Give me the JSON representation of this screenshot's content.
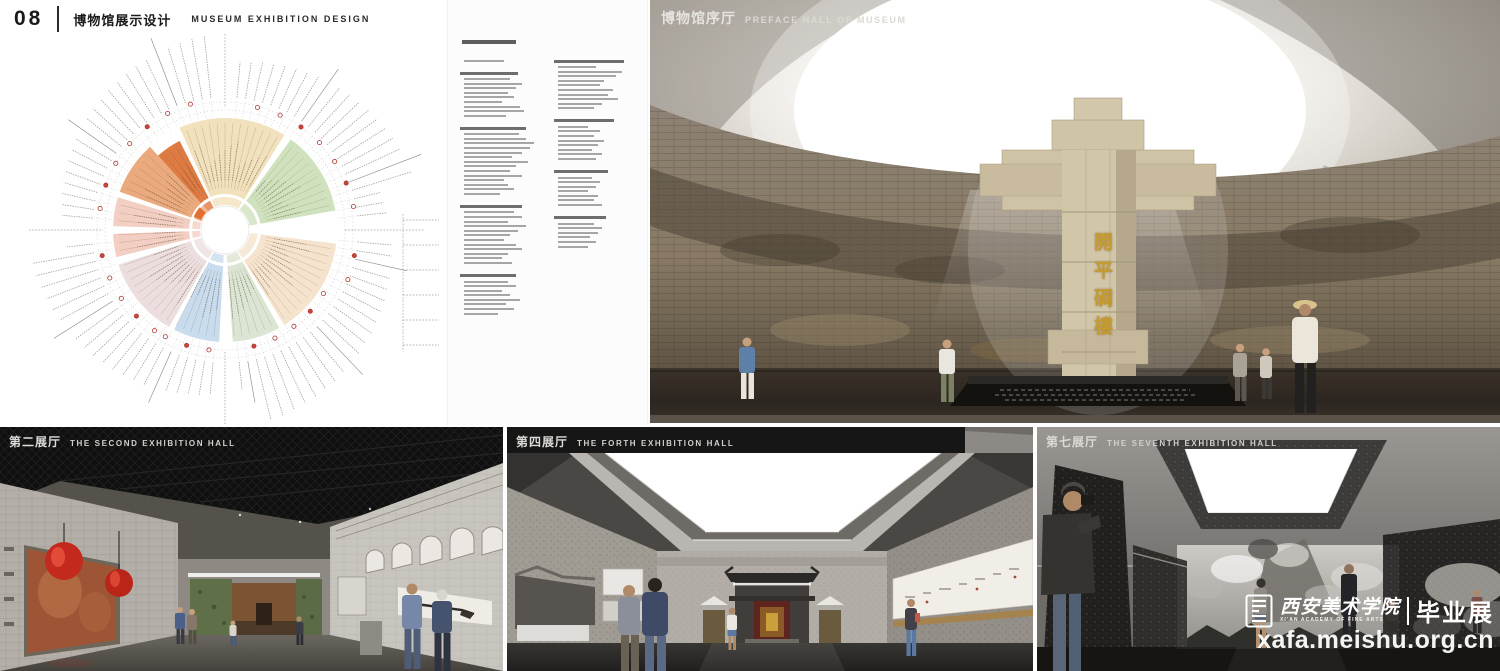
{
  "header": {
    "number": "08",
    "title_zh": "博物馆展示设计",
    "title_en": "MUSEUM EXHIBITION DESIGN"
  },
  "renders": {
    "preface": {
      "label_zh": "博物馆序厅",
      "label_en": "PREFACE HALL OF MUSEUM",
      "monument_text": "開平碉樓",
      "monument_color": "#cfc3a6",
      "gold_color": "#c59b2f"
    },
    "hall2": {
      "label_zh": "第二展厅",
      "label_en": "THE SECOND EXHIBITION HALL",
      "lantern_color": "#c32a1d"
    },
    "hall4": {
      "label_zh": "第四展厅",
      "label_en": "THE FORTH EXHIBITION HALL"
    },
    "hall7": {
      "label_zh": "第七展厅",
      "label_en": "THE SEVENTH EXHIBITION HALL"
    }
  },
  "watermark": {
    "academy_zh": "西安美术学院",
    "academy_en": "XI'AN ACADEMY OF FINE ARTS",
    "exhibition": "毕业展",
    "url": "xafa.meishu.org.cn"
  },
  "diagram": {
    "hole_radius": 18,
    "red_marker_color": "#b23a33",
    "sectors": [
      {
        "start": 336,
        "end": 392,
        "color": "#f2e1bd"
      },
      {
        "start": 36,
        "end": 80,
        "color": "#cfe2bd"
      },
      {
        "start": 97,
        "end": 148,
        "color": "#f5e3cd"
      },
      {
        "start": 151,
        "end": 176,
        "color": "#dce5d3"
      },
      {
        "start": 183,
        "end": 207,
        "color": "#c9dcee"
      },
      {
        "start": 210,
        "end": 252,
        "color": "#ecdede"
      },
      {
        "start": 256,
        "end": 268,
        "color": "#f2cfc2"
      },
      {
        "start": 272,
        "end": 287,
        "color": "#f2cfc2"
      },
      {
        "start": 290,
        "end": 318,
        "color": "#eba97e"
      },
      {
        "start": 318,
        "end": 333,
        "color": "#dd7b43",
        "r2": 100
      }
    ],
    "accent_arc": {
      "start": 293,
      "end": 312,
      "color": "#e06a2a"
    }
  },
  "outline": {
    "columns": [
      [
        {
          "h": 0,
          "lines": [
            40
          ]
        },
        {
          "h": 58,
          "lines": [
            46,
            58,
            52,
            44,
            50,
            38,
            56,
            60,
            42
          ]
        },
        {
          "h": 66,
          "lines": [
            55,
            62,
            70,
            66,
            58,
            48,
            64,
            52,
            46,
            58,
            40,
            44,
            50,
            36
          ]
        },
        {
          "h": 62,
          "lines": [
            50,
            58,
            44,
            62,
            54,
            46,
            40,
            52,
            58,
            44,
            38,
            48
          ]
        },
        {
          "h": 56,
          "lines": [
            44,
            52,
            38,
            46,
            56,
            42,
            50,
            34
          ]
        }
      ],
      [
        {
          "h": 70,
          "lines": [
            38,
            64,
            58,
            46,
            42,
            55,
            50,
            60,
            44,
            36
          ]
        },
        {
          "h": 60,
          "lines": [
            30,
            42,
            36,
            46,
            40,
            34,
            44,
            38
          ]
        },
        {
          "h": 54,
          "lines": [
            34,
            42,
            38,
            30,
            40,
            36,
            44
          ]
        },
        {
          "h": 52,
          "lines": [
            36,
            44,
            40,
            32,
            38,
            30
          ]
        }
      ]
    ]
  }
}
